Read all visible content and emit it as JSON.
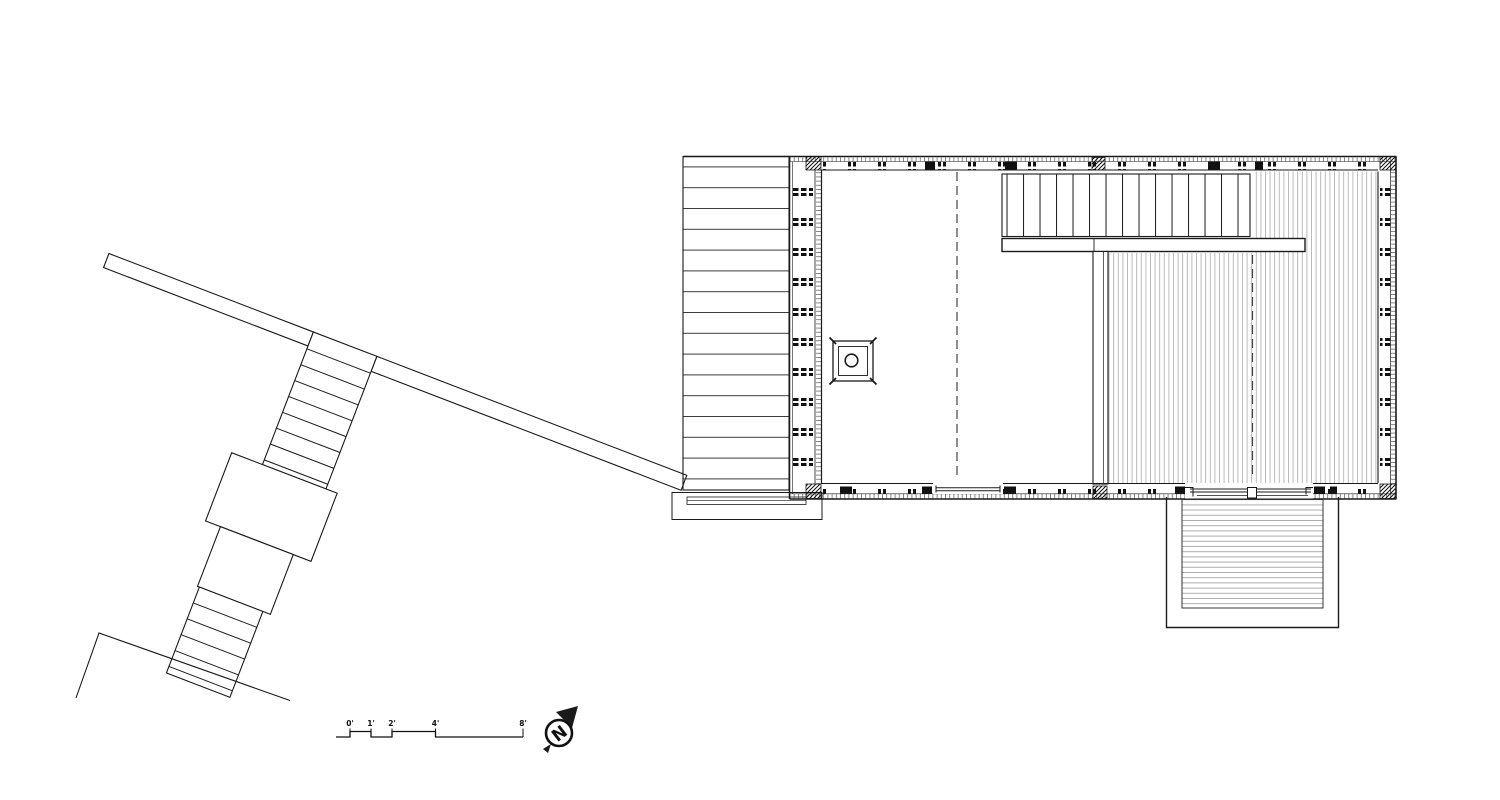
{
  "drawing": {
    "kind": "architectural floor plan",
    "background": "#ffffff"
  },
  "scale_bar": {
    "labels": [
      "0'",
      "1'",
      "2'",
      "4'",
      "8'"
    ]
  },
  "north_arrow": {
    "label": "N"
  },
  "colors": {
    "ink": "#1a1a1a",
    "plank_line": "#3a3a3a",
    "fine_hatch": "#b2b2b2",
    "balcony_line": "#9a9a9a",
    "ladder_hatch": "#555555",
    "dash_line": "#444444"
  }
}
